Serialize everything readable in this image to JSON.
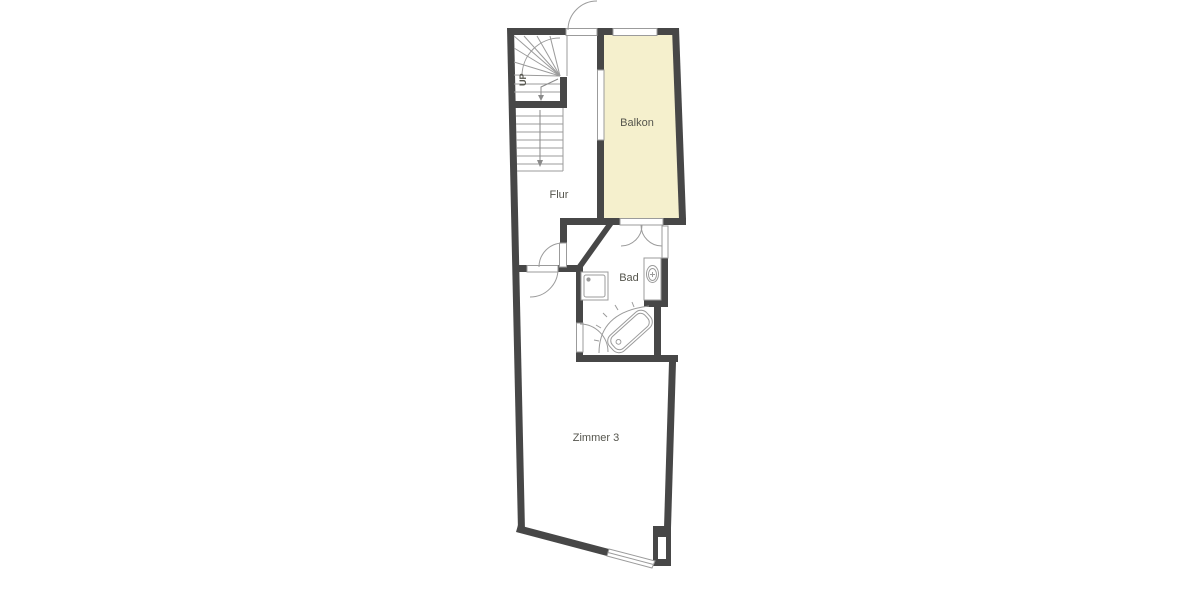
{
  "plan": {
    "labels": {
      "balcony": "Balkon",
      "hallway": "Flur",
      "bathroom": "Bad",
      "room3": "Zimmer 3",
      "stairs_direction": "UP"
    },
    "colors": {
      "wall": "#474747",
      "line": "#9b9b9b",
      "balcony_fill": "#f5f0cd",
      "text": "#55554d",
      "arrow": "#8a8a8a",
      "background": "#ffffff"
    }
  }
}
